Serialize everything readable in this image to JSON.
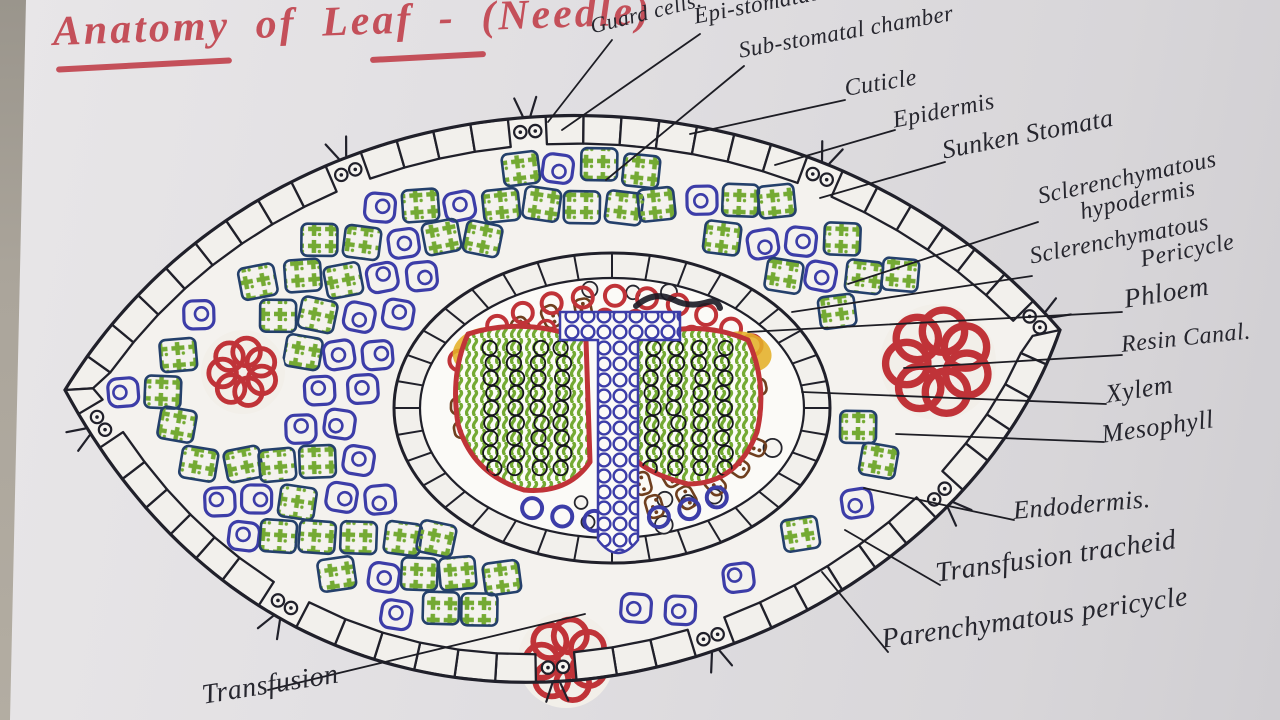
{
  "title": {
    "text": "Anatomy of Leaf - (Needle)"
  },
  "diagram": {
    "subject": "transverse-section-of-pine-needle-leaf",
    "labels": [
      {
        "id": "guard-cells",
        "text": "Guard cells."
      },
      {
        "id": "epi-stomatal-chamber",
        "text": "Epi-stomatal chamber."
      },
      {
        "id": "sub-stomatal-chamber",
        "text": "Sub-stomatal chamber"
      },
      {
        "id": "cuticle",
        "text": "Cuticle"
      },
      {
        "id": "epidermis",
        "text": "Epidermis"
      },
      {
        "id": "sunken-stomata",
        "text": "Sunken Stomata"
      },
      {
        "id": "sclerenchymatous-hypodermis",
        "text": "Sclerenchymatous",
        "text2": "hypodermis"
      },
      {
        "id": "sclerenchymatous-pericycle",
        "text": "Sclerenchymatous",
        "text2": "Pericycle"
      },
      {
        "id": "phloem",
        "text": "Phloem"
      },
      {
        "id": "resin-canal",
        "text": "Resin Canal."
      },
      {
        "id": "xylem",
        "text": "Xylem"
      },
      {
        "id": "mesophyll",
        "text": "Mesophyll"
      },
      {
        "id": "endodermis",
        "text": "Endodermis."
      },
      {
        "id": "transfusion-tracheid",
        "text": "Transfusion tracheid"
      },
      {
        "id": "parenchymatous-pericycle",
        "text": "Parenchymatous pericycle"
      },
      {
        "id": "transfusion-partial",
        "text": "Transfusion"
      }
    ],
    "colors": {
      "ink": "#20202a",
      "pen_blue": "#3c3da8",
      "pen_green": "#74aa33",
      "green_cell_border": "#24406b",
      "pen_red": "#c03338",
      "pen_brown": "#6f3f1f",
      "pen_yellow": "#e4af28",
      "title_red": "#c4505a",
      "paper": "#e2e0e2",
      "cell_fill": "#f2f0ec"
    }
  }
}
